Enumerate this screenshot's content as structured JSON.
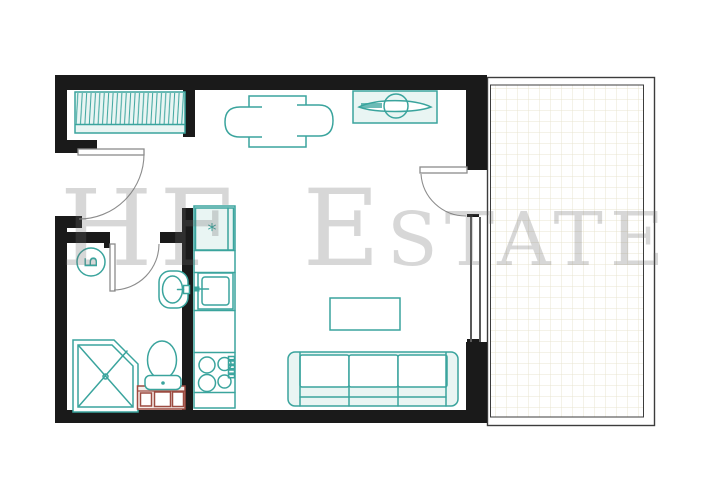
{
  "watermark": {
    "text": "HF Estate"
  },
  "symbols": {
    "boiler": "Б",
    "fridge": "*"
  },
  "colors": {
    "wall": "#1a1a1a",
    "furniture": "#3aa49d",
    "furniture-fill": "#e9f5f3",
    "vanity": "#9c4b41",
    "vanity-fill": "#f8efec",
    "door": "#8c8c8c",
    "grid": "#e9e4d1",
    "window-line": "#5a5a5a",
    "watermark": "rgba(107,107,107,0.27)",
    "background": "#ffffff"
  }
}
